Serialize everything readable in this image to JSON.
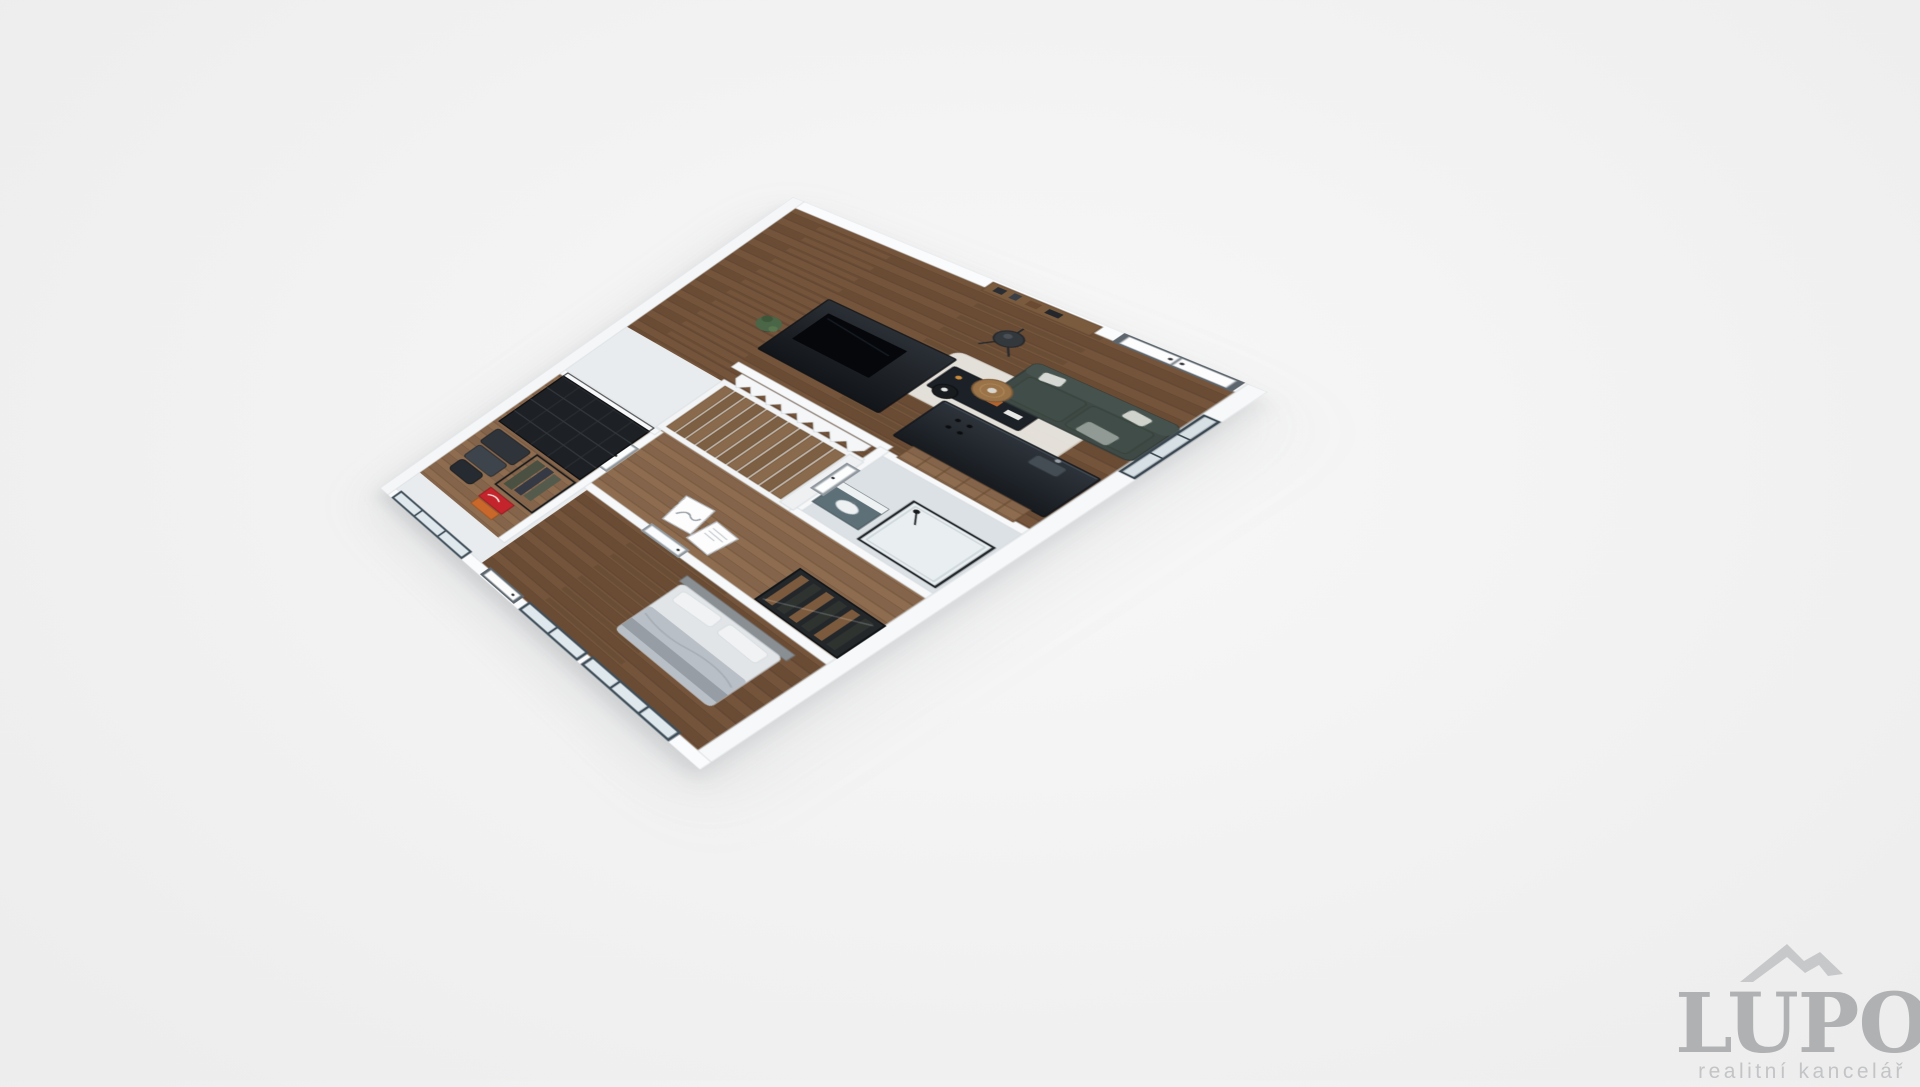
{
  "watermark": {
    "brand": "LUPO",
    "tagline": "realitní kancelář",
    "logo_icon": "mountain-peaks-icon",
    "brand_color": "#b0b1b3",
    "tagline_color": "#c3c4c6",
    "icon_color": "#c7c8c9"
  },
  "scene": {
    "type": "3d-cutaway-floorplan-render",
    "background_color": "#f1f1f2",
    "palette": {
      "outer_walls": "#fafbfc",
      "wall_edge": "#d8dcdf",
      "wood_floor_dark": "#6f5138",
      "wood_floor_light": "#8a6a4e",
      "dark_furniture": "#1d2126",
      "kitchen_counter": "#22272e",
      "sofa_green": "#3f4a46",
      "glass_frame_slate": "#3f4e59",
      "accent_red_box": "#c4242b",
      "accent_orange": "#c9682a",
      "vanity_teal": "#5d7077"
    },
    "entrance": "double-door",
    "rooms": [
      {
        "name": "living-room",
        "items": [
          "tv-partition",
          "tv-screen",
          "media-console",
          "potted-plant",
          "tripod-floor-lamp",
          "wall-shelves",
          "corner-sofa",
          "round-coffee-table",
          "black-side-table",
          "white-rug"
        ]
      },
      {
        "name": "kitchen",
        "items": [
          "dark-island-counter",
          "hob",
          "sink",
          "wood-cabinet-front"
        ]
      },
      {
        "name": "hallway",
        "items": [
          "staircase",
          "zigzag-balustrade-wall",
          "leaning-art-prints",
          "interior-doors"
        ]
      },
      {
        "name": "bathroom",
        "items": [
          "glass-shower",
          "teal-vanity"
        ]
      },
      {
        "name": "storage-room",
        "items": [
          "black-metal-shelving",
          "clothes-rack",
          "luggage-bags",
          "red-shoe-box"
        ]
      },
      {
        "name": "bedroom",
        "items": [
          "double-bed",
          "glass-door-wardrobe",
          "glass-partition-windows"
        ]
      }
    ]
  }
}
